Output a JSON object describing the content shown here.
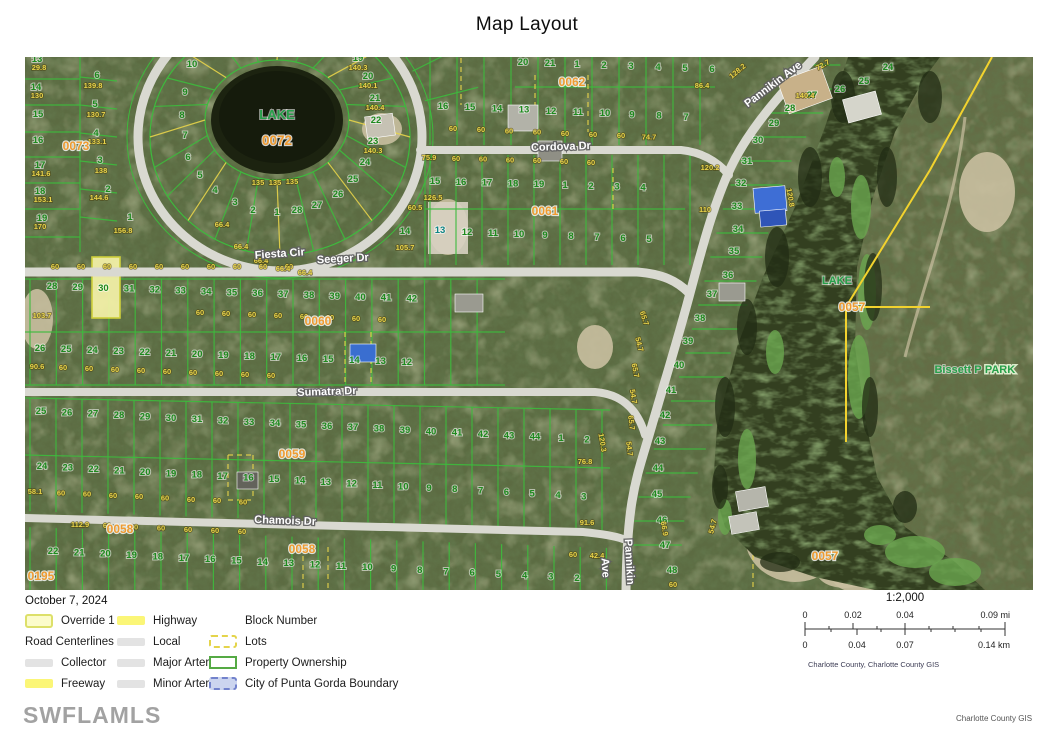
{
  "title": "Map Layout",
  "date": "October 7, 2024",
  "watermark": "SWFLAMLS",
  "credit": "Charlotte County GIS",
  "colors": {
    "terrain_base": "#5c6b42",
    "water_lake": "#1c2310",
    "water_channel": "#333f20",
    "parcel_line_green": "#3dbb3d",
    "lots_dash_yellow": "#e8d44a",
    "boundary_yellow": "#f2d22e",
    "road_fill": "#d9d9d1",
    "lot_number_green": "#1e8a1e",
    "dimension_yellow": "#e9d44b",
    "block_number_orange": "#ef9b30",
    "lake_label_green": "#27a04a",
    "cleared_lot_teal": "#0e8585"
  },
  "legend": {
    "groups": [
      {
        "items": [
          {
            "label": "Override 1",
            "swatch": "override"
          },
          {
            "label": "Road Centerlines",
            "swatch": "none",
            "full": true
          },
          {
            "label": "Collector",
            "swatch": "road-gray"
          },
          {
            "label": "Freeway",
            "swatch": "road-yellow"
          }
        ]
      },
      {
        "items": [
          {
            "label": "Highway",
            "swatch": "road-yellow"
          },
          {
            "label": "Local",
            "swatch": "road-gray"
          },
          {
            "label": "Major Arterial",
            "swatch": "road-gray"
          },
          {
            "label": "Minor Arterial",
            "swatch": "road-gray"
          }
        ]
      },
      {
        "items": [
          {
            "label": "Block Number",
            "swatch": "none"
          },
          {
            "label": "Lots",
            "swatch": "lots"
          },
          {
            "label": "Property Ownership",
            "swatch": "ownership"
          },
          {
            "label": "City of Punta Gorda Boundary",
            "swatch": "city"
          }
        ]
      }
    ]
  },
  "scalebar": {
    "ratio": "1:2,000",
    "mi_labels": [
      "0",
      "0.02",
      "0.04",
      "0.09 mi"
    ],
    "km_labels": [
      "0",
      "0.04",
      "0.07",
      "0.14 km"
    ],
    "attribution": "Charlotte County, Charlotte County GIS"
  },
  "map": {
    "road_labels": [
      {
        "t": "Fiesta Cir",
        "x": 255,
        "y": 200,
        "r": -4
      },
      {
        "t": "Seeger Dr",
        "x": 318,
        "y": 205,
        "r": -3
      },
      {
        "t": "Cordova Dr",
        "x": 536,
        "y": 93,
        "r": -2
      },
      {
        "t": "Sumatra Dr",
        "x": 302,
        "y": 338,
        "r": -2
      },
      {
        "t": "Chamois Dr",
        "x": 260,
        "y": 467,
        "r": 2
      },
      {
        "t": "Pannikin Ave",
        "x": 750,
        "y": 30,
        "r": -37
      },
      {
        "t": "Pannikin",
        "x": 601,
        "y": 505,
        "r": 87
      },
      {
        "t": "Ave",
        "x": 577,
        "y": 511,
        "r": 87
      }
    ],
    "block_labels": [
      {
        "t": "0073",
        "x": 51,
        "y": 93
      },
      {
        "t": "0062",
        "x": 547,
        "y": 29
      },
      {
        "t": "0061",
        "x": 520,
        "y": 158
      },
      {
        "t": "0060",
        "x": 293,
        "y": 268
      },
      {
        "t": "0059",
        "x": 267,
        "y": 401
      },
      {
        "t": "0058",
        "x": 95,
        "y": 476
      },
      {
        "t": "0058",
        "x": 277,
        "y": 496
      },
      {
        "t": "0195",
        "x": 16,
        "y": 523
      },
      {
        "t": "0057",
        "x": 827,
        "y": 254
      },
      {
        "t": "0057",
        "x": 800,
        "y": 503
      }
    ],
    "area_labels": [
      {
        "t": "LAKE",
        "x": 252,
        "y": 62,
        "cls": "lake"
      },
      {
        "t": "0072",
        "x": 252,
        "y": 88,
        "cls": "blk big"
      },
      {
        "t": "LAKE",
        "x": 812,
        "y": 227,
        "cls": "lake sm"
      },
      {
        "t": "Bissett P",
        "x": 933,
        "y": 316,
        "cls": "lake sm"
      },
      {
        "t": "PARK",
        "x": 975,
        "y": 316,
        "cls": "lake sm park"
      }
    ],
    "rows": [
      {
        "c": "lot",
        "l": [
          "20",
          "21",
          "1",
          "2",
          "3",
          "4",
          "5",
          "6"
        ],
        "x": 498,
        "y": 8,
        "dx": 27,
        "dy": 1
      },
      {
        "c": "lot",
        "l": [
          "16",
          "15",
          "14",
          "13",
          "12",
          "11",
          "10",
          "9",
          "8",
          "7"
        ],
        "x": 418,
        "y": 52,
        "dx": 27,
        "dy": 1.2
      },
      {
        "c": "dim",
        "l": [
          "60",
          "60",
          "60",
          "60",
          "60",
          "60",
          "60",
          "74.7"
        ],
        "x": 428,
        "y": 74,
        "dx": 28,
        "dy": 1.2
      },
      {
        "c": "dim",
        "l": [
          "75.9",
          "60",
          "60",
          "60",
          "60",
          "60",
          "60"
        ],
        "x": 404,
        "y": 103,
        "dx": 27,
        "dy": 0.8
      },
      {
        "c": "lot",
        "l": [
          "15",
          "16",
          "17",
          "18",
          "19",
          "1",
          "2",
          "3",
          "4"
        ],
        "x": 410,
        "y": 127,
        "dx": 26,
        "dy": 0.8
      },
      {
        "c": "lot",
        "l": [
          "14"
        ],
        "x": 380,
        "y": 177,
        "dx": 26,
        "dy": 0
      },
      {
        "c": "lot",
        "l": [
          "12",
          "11",
          "10",
          "9",
          "8",
          "7",
          "6",
          "5"
        ],
        "x": 442,
        "y": 178,
        "dx": 26,
        "dy": 1
      },
      {
        "c": "lot",
        "l": [
          "28",
          "29",
          "30",
          "31",
          "32",
          "33",
          "34",
          "35",
          "36",
          "37",
          "38",
          "39",
          "40",
          "41",
          "42"
        ],
        "x": 27,
        "y": 232,
        "dx": 25.7,
        "dy": 0.9
      },
      {
        "c": "dim",
        "l": [
          "60",
          "60",
          "60",
          "60",
          "60",
          "60",
          "60",
          "60",
          "60",
          "60"
        ],
        "x": 30,
        "y": 212,
        "dx": 26,
        "dy": 0
      },
      {
        "c": "lot",
        "l": [
          "26",
          "25",
          "24",
          "23",
          "22",
          "21",
          "20",
          "19",
          "18",
          "17",
          "16",
          "15",
          "14",
          "13",
          "12"
        ],
        "x": 15,
        "y": 294,
        "dx": 26.2,
        "dy": 1
      },
      {
        "c": "dim",
        "l": [
          "90.6",
          "60",
          "60",
          "60",
          "60",
          "60",
          "60",
          "60",
          "60",
          "60"
        ],
        "x": 12,
        "y": 312,
        "dx": 26,
        "dy": 1
      },
      {
        "c": "dim",
        "l": [
          "60",
          "60",
          "60",
          "60",
          "60",
          "60",
          "60",
          "60"
        ],
        "x": 175,
        "y": 258,
        "dx": 26,
        "dy": 1
      },
      {
        "c": "lot",
        "l": [
          "25",
          "26",
          "27",
          "28",
          "29",
          "30",
          "31",
          "32",
          "33",
          "34",
          "35",
          "36",
          "37",
          "38",
          "39",
          "40",
          "41",
          "42",
          "43",
          "44",
          "1",
          "2"
        ],
        "x": 16,
        "y": 357,
        "dx": 26,
        "dy": 1.35
      },
      {
        "c": "lot",
        "l": [
          "24",
          "23",
          "22",
          "21",
          "20",
          "19",
          "18",
          "17",
          "16",
          "15",
          "14",
          "13",
          "12",
          "11",
          "10",
          "9",
          "8",
          "7",
          "6",
          "5",
          "4",
          "3"
        ],
        "x": 17,
        "y": 412,
        "dx": 25.8,
        "dy": 1.45
      },
      {
        "c": "dim",
        "l": [
          "58.1",
          "60",
          "60",
          "60",
          "60",
          "60",
          "60",
          "60",
          "60"
        ],
        "x": 10,
        "y": 437,
        "dx": 26,
        "dy": 1.3
      },
      {
        "c": "dim",
        "l": [
          "112.9",
          "60",
          "60",
          "60",
          "60",
          "60",
          "60"
        ],
        "x": 55,
        "y": 470,
        "dx": 27,
        "dy": 1.2
      },
      {
        "c": "lot",
        "l": [
          "22",
          "21",
          "20",
          "19",
          "18",
          "17",
          "16",
          "15",
          "14",
          "13",
          "12",
          "11",
          "10",
          "9",
          "8",
          "7",
          "6",
          "5",
          "4",
          "3",
          "2"
        ],
        "x": 28,
        "y": 497,
        "dx": 26.2,
        "dy": 1.35
      }
    ],
    "right_lots": [
      [
        "24",
        863,
        13
      ],
      [
        "25",
        839,
        27
      ],
      [
        "26",
        815,
        35
      ],
      [
        "27",
        787,
        41
      ],
      [
        "28",
        765,
        54
      ],
      [
        "29",
        749,
        69
      ],
      [
        "30",
        733,
        86
      ],
      [
        "31",
        722,
        107
      ],
      [
        "32",
        716,
        129
      ],
      [
        "33",
        712,
        152
      ],
      [
        "34",
        713,
        175
      ],
      [
        "35",
        709,
        197
      ],
      [
        "36",
        703,
        221
      ],
      [
        "37",
        687,
        240
      ],
      [
        "38",
        675,
        264
      ],
      [
        "39",
        663,
        287
      ],
      [
        "40",
        654,
        311
      ],
      [
        "41",
        646,
        336
      ],
      [
        "42",
        640,
        361
      ],
      [
        "43",
        635,
        387
      ],
      [
        "44",
        633,
        414
      ],
      [
        "45",
        632,
        440
      ],
      [
        "46",
        637,
        466
      ],
      [
        "47",
        640,
        491
      ],
      [
        "48",
        647,
        516
      ]
    ],
    "scattered": [
      [
        "13",
        12,
        5
      ],
      [
        "14",
        11,
        33
      ],
      [
        "15",
        13,
        60
      ],
      [
        "16",
        13,
        86
      ],
      [
        "17",
        15,
        111
      ],
      [
        "18",
        15,
        137
      ],
      [
        "19",
        17,
        164
      ],
      [
        "29.8",
        14,
        13,
        "dim"
      ],
      [
        "130",
        12,
        41,
        "dim"
      ],
      [
        "141.6",
        16,
        119,
        "dim"
      ],
      [
        "153.1",
        18,
        145,
        "dim"
      ],
      [
        "170",
        15,
        172,
        "dim"
      ],
      [
        "6",
        72,
        21
      ],
      [
        "5",
        70,
        50
      ],
      [
        "4",
        71,
        79
      ],
      [
        "3",
        75,
        106
      ],
      [
        "2",
        83,
        135
      ],
      [
        "1",
        105,
        163
      ],
      [
        "139.8",
        68,
        31,
        "dim"
      ],
      [
        "130.7",
        71,
        60,
        "dim"
      ],
      [
        "133.1",
        72,
        87,
        "dim"
      ],
      [
        "138",
        76,
        116,
        "dim"
      ],
      [
        "144.6",
        74,
        143,
        "dim"
      ],
      [
        "156.8",
        98,
        176,
        "dim"
      ],
      [
        "103.7",
        17,
        261,
        "dim"
      ],
      [
        "10",
        167,
        10
      ],
      [
        "9",
        160,
        38
      ],
      [
        "8",
        157,
        61
      ],
      [
        "7",
        160,
        81
      ],
      [
        "6",
        163,
        103
      ],
      [
        "5",
        175,
        121
      ],
      [
        "4",
        190,
        136
      ],
      [
        "3",
        210,
        148
      ],
      [
        "2",
        228,
        156
      ],
      [
        "1",
        252,
        158
      ],
      [
        "19",
        333,
        4
      ],
      [
        "20",
        343,
        22
      ],
      [
        "21",
        350,
        44
      ],
      [
        "22",
        351,
        66
      ],
      [
        "23",
        348,
        87
      ],
      [
        "24",
        340,
        108
      ],
      [
        "25",
        328,
        125
      ],
      [
        "26",
        313,
        140
      ],
      [
        "27",
        292,
        151
      ],
      [
        "28",
        272,
        156
      ],
      [
        "140.3",
        333,
        13,
        "dim"
      ],
      [
        "140.1",
        343,
        31,
        "dim"
      ],
      [
        "140.4",
        350,
        53,
        "dim"
      ],
      [
        "140.3",
        348,
        96,
        "dim"
      ],
      [
        "135",
        233,
        128,
        "dim"
      ],
      [
        "135",
        250,
        128,
        "dim"
      ],
      [
        "135",
        267,
        127,
        "dim"
      ],
      [
        "66.4",
        197,
        170,
        "dim"
      ],
      [
        "66.4",
        216,
        192,
        "dim"
      ],
      [
        "66.4",
        236,
        206,
        "dim"
      ],
      [
        "66.4",
        258,
        214,
        "dim"
      ],
      [
        "66.4",
        280,
        218,
        "dim"
      ],
      [
        "13",
        415,
        176,
        "teal"
      ],
      [
        "86.4",
        677,
        31,
        "dim"
      ],
      [
        "140.4",
        780,
        41,
        "dim"
      ],
      [
        "128.2",
        714,
        16,
        "dim",
        -40
      ],
      [
        "72.7",
        799,
        10,
        "dim",
        -30
      ],
      [
        "126.5",
        408,
        143,
        "dim"
      ],
      [
        "60.5",
        390,
        153,
        "dim"
      ],
      [
        "105.7",
        380,
        193,
        "dim"
      ],
      [
        "110",
        680,
        155,
        "dim"
      ],
      [
        "120.2",
        685,
        113,
        "dim"
      ],
      [
        "120.8",
        763,
        141,
        "dim",
        80
      ],
      [
        "65.7",
        617,
        262,
        "dim",
        72
      ],
      [
        "54.7",
        612,
        288,
        "dim",
        75
      ],
      [
        "65.7",
        608,
        314,
        "dim",
        78
      ],
      [
        "54.7",
        606,
        340,
        "dim",
        80
      ],
      [
        "65.7",
        604,
        366,
        "dim",
        82
      ],
      [
        "54.7",
        602,
        392,
        "dim",
        83
      ],
      [
        "66.9",
        637,
        472,
        "dim",
        80
      ],
      [
        "54.7",
        690,
        470,
        "dim",
        -75
      ],
      [
        "120.3",
        575,
        386,
        "dim",
        80
      ],
      [
        "76.8",
        560,
        407,
        "dim"
      ],
      [
        "91.6",
        562,
        468,
        "dim"
      ],
      [
        "42.4",
        572,
        501,
        "dim"
      ],
      [
        "60",
        548,
        500,
        "dim"
      ],
      [
        "60",
        648,
        530,
        "dim"
      ]
    ]
  }
}
